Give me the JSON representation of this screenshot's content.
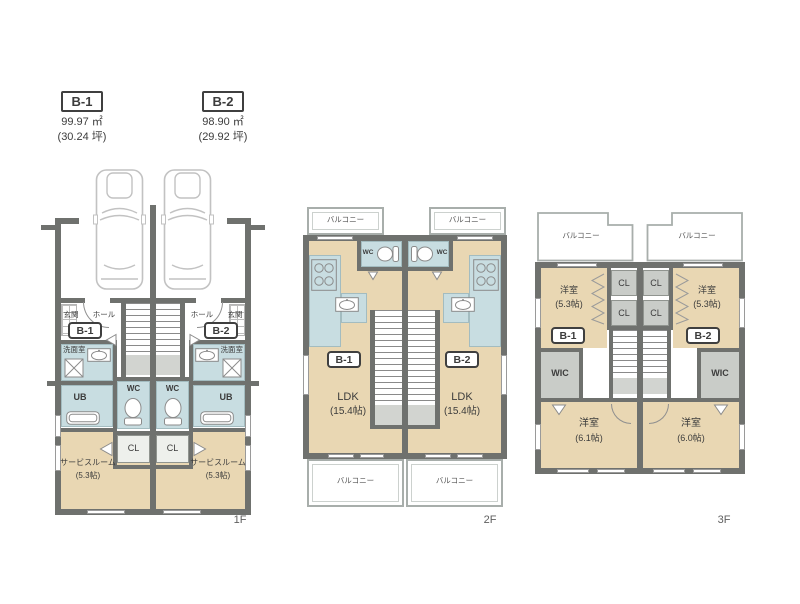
{
  "header": {
    "b1": {
      "name": "B-1",
      "area_m2": "99.97 ㎡",
      "area_tsubo": "(30.24 坪)"
    },
    "b2": {
      "name": "B-2",
      "area_m2": "98.90 ㎡",
      "area_tsubo": "(29.92 坪)"
    }
  },
  "labels": {
    "balcony": "バルコニー",
    "entrance": "玄関",
    "hall": "ホール",
    "washroom": "洗面室",
    "bath": "UB",
    "wc": "WC",
    "closet": "CL",
    "wic": "WIC",
    "service_room": "サービスルーム",
    "service_size": "(5.3帖)",
    "ldk": "LDK",
    "ldk_size": "(15.4帖)",
    "bedroom": "洋室",
    "bedroom_size_53": "(5.3帖)",
    "bedroom_size_61": "(6.1帖)",
    "bedroom_size_60": "(6.0帖)",
    "unit_b1": "B-1",
    "unit_b2": "B-2"
  },
  "floors": {
    "f1": "1F",
    "f2": "2F",
    "f3": "3F"
  },
  "colors": {
    "wall": "#6f716e",
    "floor_tan": "#e9d7b3",
    "wet_blue": "#c8dde1",
    "closet_gray": "#c9ccc8",
    "outline_gray": "#c2c2c2"
  }
}
